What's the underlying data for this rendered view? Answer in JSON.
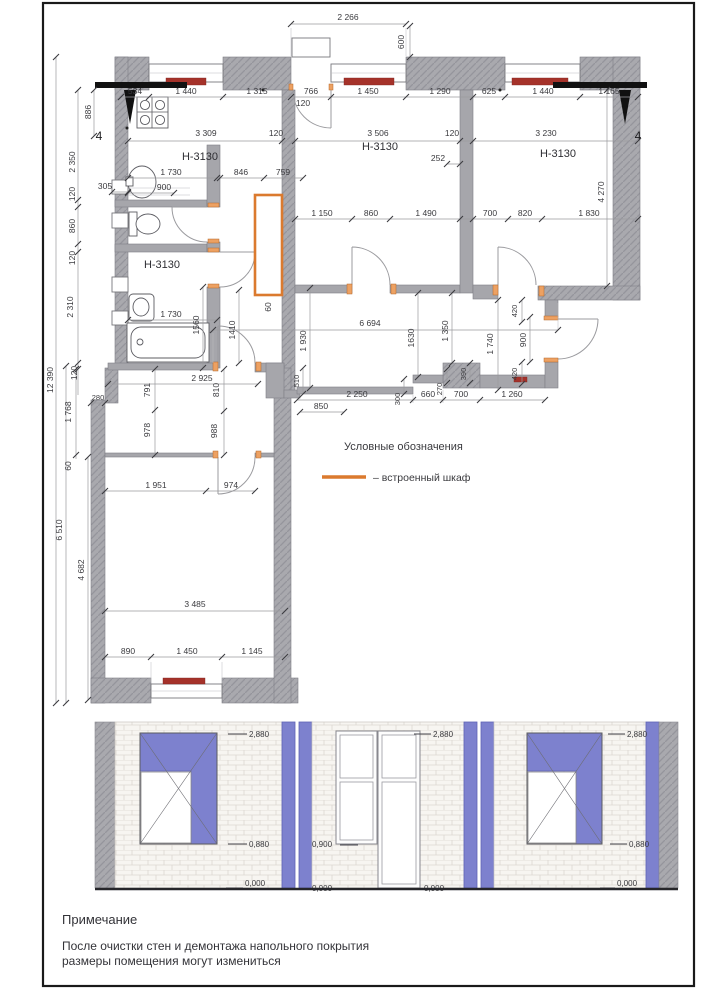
{
  "plan": {
    "rooms": {
      "kitchen": "Н-3130",
      "bath": "Н-3130",
      "middle": "Н-3130",
      "right": "Н-3130"
    },
    "section_mark": "4",
    "dims": {
      "top": [
        "2 266",
        "600"
      ],
      "row1": [
        "534",
        "1 440",
        "1 315",
        "766",
        "120",
        "1 450",
        "1 290",
        "625",
        "1 440",
        "1 165"
      ],
      "row2": [
        "3 309",
        "120",
        "3 506",
        "120",
        "3 230",
        "252",
        "4 270"
      ],
      "left": [
        "886",
        "2 350",
        "120",
        "305",
        "860",
        "120",
        "2 310",
        "120",
        "12 390",
        "1 768",
        "280",
        "60",
        "6 510",
        "4 682"
      ],
      "kitchen": [
        "1 730",
        "900",
        "846",
        "759"
      ],
      "midrow": [
        "1 150",
        "860",
        "1 490",
        "700",
        "820",
        "1 830"
      ],
      "bath": [
        "1 730",
        "1560",
        "1410",
        "2 925",
        "60"
      ],
      "corridor": [
        "6 694",
        "1 930",
        "1630",
        "1 350",
        "510",
        "300",
        "2 250",
        "660",
        "700",
        "1 260",
        "270",
        "390",
        "420",
        "900",
        "420",
        "1 740"
      ],
      "hall": [
        "791",
        "978",
        "810",
        "988",
        "850",
        "1 951",
        "974"
      ],
      "bottom": [
        "3 485",
        "890",
        "1 450",
        "1 145"
      ]
    }
  },
  "legend": {
    "title": "Условные обозначения",
    "wardrobe_label": "– встроенный шкаф"
  },
  "elevations": {
    "left": {
      "top": "2,880",
      "sill": "0,880",
      "floor": "0,000"
    },
    "middle": {
      "top": "2,880",
      "sill": "0,900",
      "floor_left": "0,000",
      "floor_right": "0,000"
    },
    "right": {
      "top": "2,880",
      "sill": "0,880",
      "floor": "0,000"
    }
  },
  "notes": {
    "title": "Примечание",
    "line1": "После очистки стен и демонтажа напольного покрытия",
    "line2": "размеры помещения могут измениться"
  },
  "colors": {
    "wall": "#a9a9ae",
    "radiator": "#a5322a",
    "wardrobe_accent": "#db7a2e",
    "door_jamb": "#eda162",
    "elevation_purple": "#7d81ce",
    "brick": "#f7f5f1"
  }
}
